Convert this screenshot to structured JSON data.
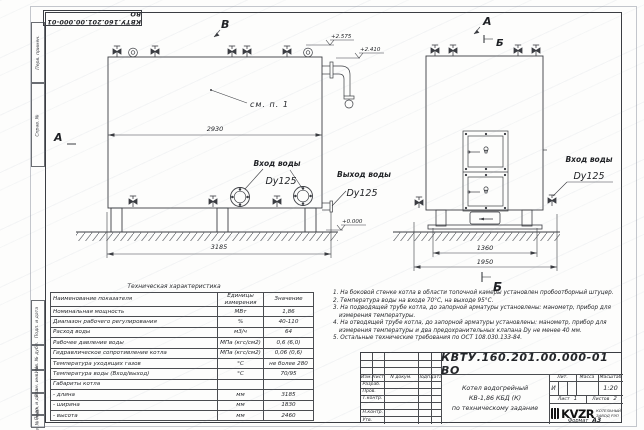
{
  "page": {
    "format_label": "Формат",
    "format_value": "А3"
  },
  "frame": {
    "top_stamp": "КВТУ.160.201.00.000-01 ВО",
    "left_labels": [
      "Перв. примен.",
      "Справ. №",
      "Подп. и дата",
      "Инв. № дубл.",
      "Взам. инв. №",
      "Подп. и дата",
      "Инв. № подл."
    ]
  },
  "views": {
    "left": {
      "view_label_top": "В",
      "section_label_left": "А",
      "see_note": "см. п. 1",
      "dim_width": "2930",
      "dim_length": "3185",
      "elev_top": "+2.575",
      "elev_mid": "+2.410",
      "elev_zero": "+0.000",
      "inlet_label": "Вход воды",
      "inlet_dn": "Dy125",
      "outlet_label": "Выход воды",
      "outlet_dn": "Dy125"
    },
    "right": {
      "view_label_a": "А",
      "view_label_b": "Б",
      "section_label_bottom": "Б",
      "dim_inner": "1360",
      "dim_outer": "1950",
      "inlet_label": "Вход воды",
      "inlet_dn": "Dy125"
    }
  },
  "spec_table": {
    "title": "Техническая характеристика",
    "headers": [
      "Наименование показателя",
      "Единицы измерения",
      "Значение"
    ],
    "rows": [
      [
        "Номинальная мощность",
        "МВт",
        "1,86"
      ],
      [
        "Диапазон рабочего регулирования",
        "%",
        "40-110"
      ],
      [
        "Расход воды",
        "м3/ч",
        "64"
      ],
      [
        "Рабочее давление воды",
        "МПа (кгс/см2)",
        "0,6 (6,0)"
      ],
      [
        "Гидравлическое сопротивление котла",
        "МПа (кгс/см2)",
        "0,06 (0,6)"
      ],
      [
        "Температура уходящих газов",
        "°С",
        "не более 280"
      ],
      [
        "Температура воды (Вход/выход)",
        "°С",
        "70/95"
      ],
      [
        "Габариты котла",
        "",
        ""
      ],
      [
        "- длина",
        "мм",
        "3185"
      ],
      [
        "- ширина",
        "мм",
        "1830"
      ],
      [
        "- высота",
        "мм",
        "2460"
      ]
    ]
  },
  "notes": {
    "items": [
      "1. На боковой стенке котла в области топочной камеры установлен пробоотборный штуцер.",
      "2. Температура воды на входе 70°С, на выходе 95°С.",
      "3. На подводящей трубе котла, до запорной арматуры установлены: манометр, прибор для измерения температуры.",
      "4. На отводящей трубе котла, до запорной арматуры установлены: манометр, прибор для измерения температуры и два предохранительных клапана Dу не менее 40 мм.",
      "5. Остальные технические требования по ОСТ 108.030.133-84."
    ]
  },
  "title_block": {
    "doc_number": "КВТУ.160.201.00.000-01 ВО",
    "header_cols": [
      "Изм.",
      "Лист",
      "N докум.",
      "Подп.",
      "Дата"
    ],
    "row_labels": [
      "Разраб.",
      "Пров.",
      "Т.контр.",
      "",
      "Н.контр.",
      "Утв."
    ],
    "name_lines": [
      "Котел водогрейный",
      "КВ-1,86 КБД (К)",
      "по техническому задание"
    ],
    "lit_header": "Лит.",
    "lit_value": "И",
    "mass_header": "Масса",
    "scale_header": "Масштаб",
    "scale_value": "1:20",
    "sheet_label": "Лист",
    "sheet_value": "1",
    "sheets_label": "Листов",
    "sheets_value": "2",
    "company_logo": "KVZR",
    "company_name_lines": [
      "КОТЕЛЬНЫЙ",
      "ЗАВОД РЭП"
    ]
  }
}
